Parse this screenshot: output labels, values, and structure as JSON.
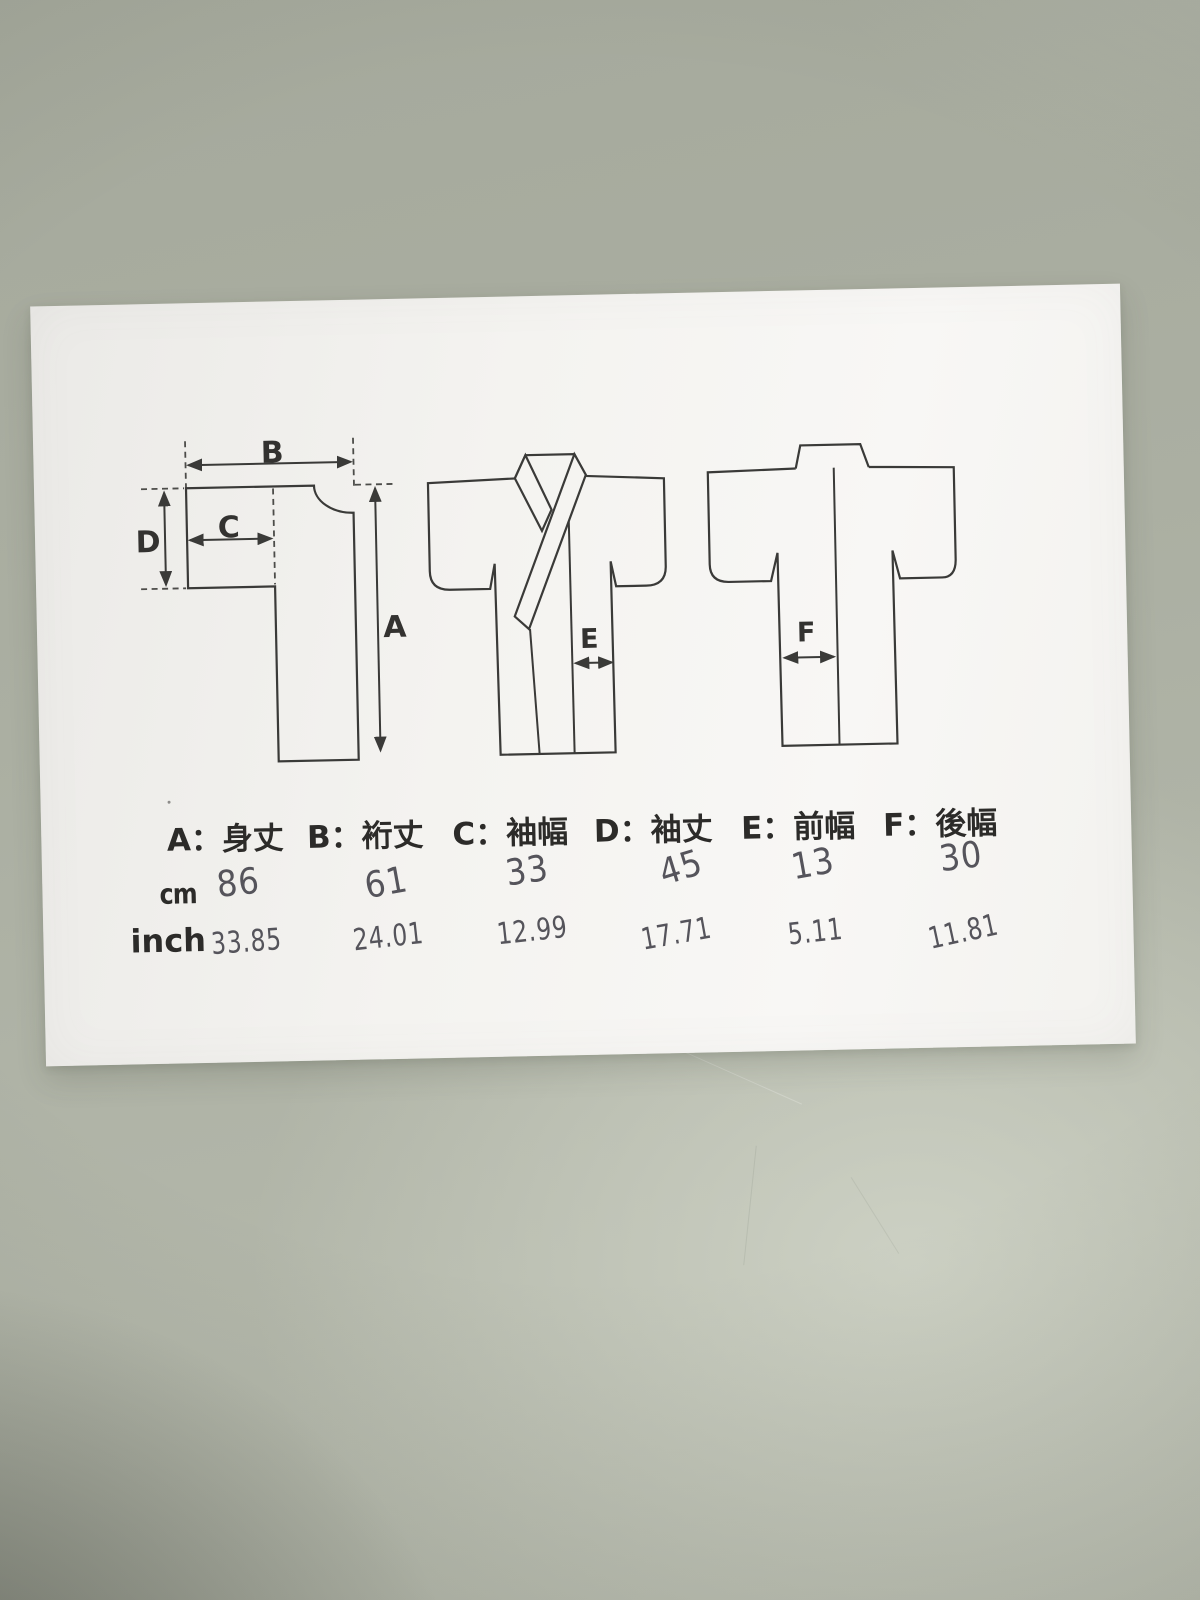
{
  "colors": {
    "table_surface": "#aeb2a5",
    "paper": "#f5f4f1",
    "ink": "#2f2e2c",
    "handwriting": "#55545b"
  },
  "paper": {
    "dimension_labels": {
      "A": "A",
      "B": "B",
      "C": "C",
      "D": "D",
      "E": "E",
      "F": "F"
    },
    "legend": {
      "items": [
        {
          "text": "A：身丈"
        },
        {
          "text": "B：裄丈"
        },
        {
          "text": "C：袖幅"
        },
        {
          "text": "D：袖丈"
        },
        {
          "text": "E：前幅"
        },
        {
          "text": "F：後幅"
        }
      ]
    },
    "size_table": {
      "rows": [
        {
          "unit": "cm",
          "values": [
            "86",
            "61",
            "33",
            "45",
            "13",
            "30"
          ]
        },
        {
          "unit": "inch",
          "values": [
            "33.85",
            "24.01",
            "12.99",
            "17.71",
            "5.11",
            "11.81"
          ]
        }
      ]
    }
  }
}
